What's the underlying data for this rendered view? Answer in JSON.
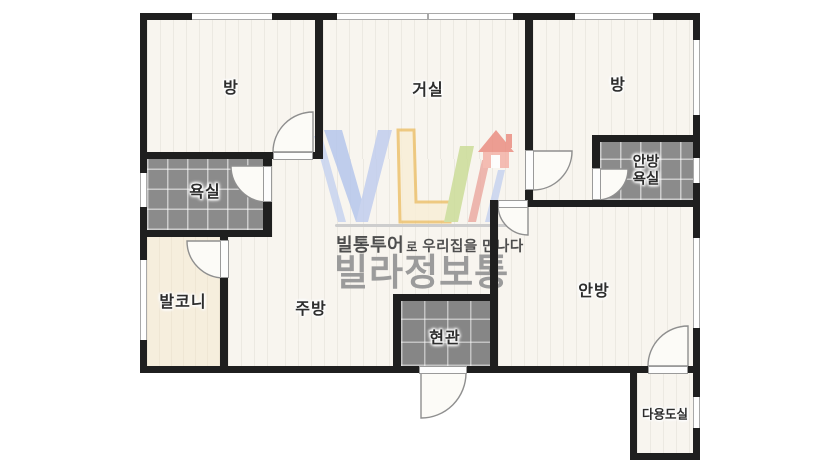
{
  "watermark": {
    "tagline_bold": "빌통투어",
    "tagline_particle": "로",
    "tagline_rest": "우리집을 만나다",
    "brand": "빌라정보통",
    "colors": {
      "v_blue": "#b3c5ec",
      "l_orange": "#ecc06a",
      "l_fill": "#f8eed6",
      "slash_green": "#cadc96",
      "slash_red": "#eba9a0",
      "house_red": "#ea8a7e",
      "house_body": "#f4b0a5"
    }
  },
  "rooms": {
    "room_top_left": {
      "label": "방"
    },
    "living_room": {
      "label": "거실"
    },
    "room_top_right": {
      "label": "방"
    },
    "bathroom": {
      "label": "욕실"
    },
    "master_bathroom": {
      "label_line1": "안방",
      "label_line2": "욕실"
    },
    "balcony": {
      "label": "발코니"
    },
    "kitchen": {
      "label": "주방"
    },
    "entrance": {
      "label": "현관"
    },
    "master_bedroom": {
      "label": "안방"
    },
    "utility_room": {
      "label": "다용도실"
    }
  },
  "colors": {
    "wall": "#1f1f1f",
    "plank_floor": "#f8f5ef",
    "tile_floor": "#8b8b8b",
    "balcony_floor": "#f6eedd",
    "label_text": "#2d2d2d"
  }
}
